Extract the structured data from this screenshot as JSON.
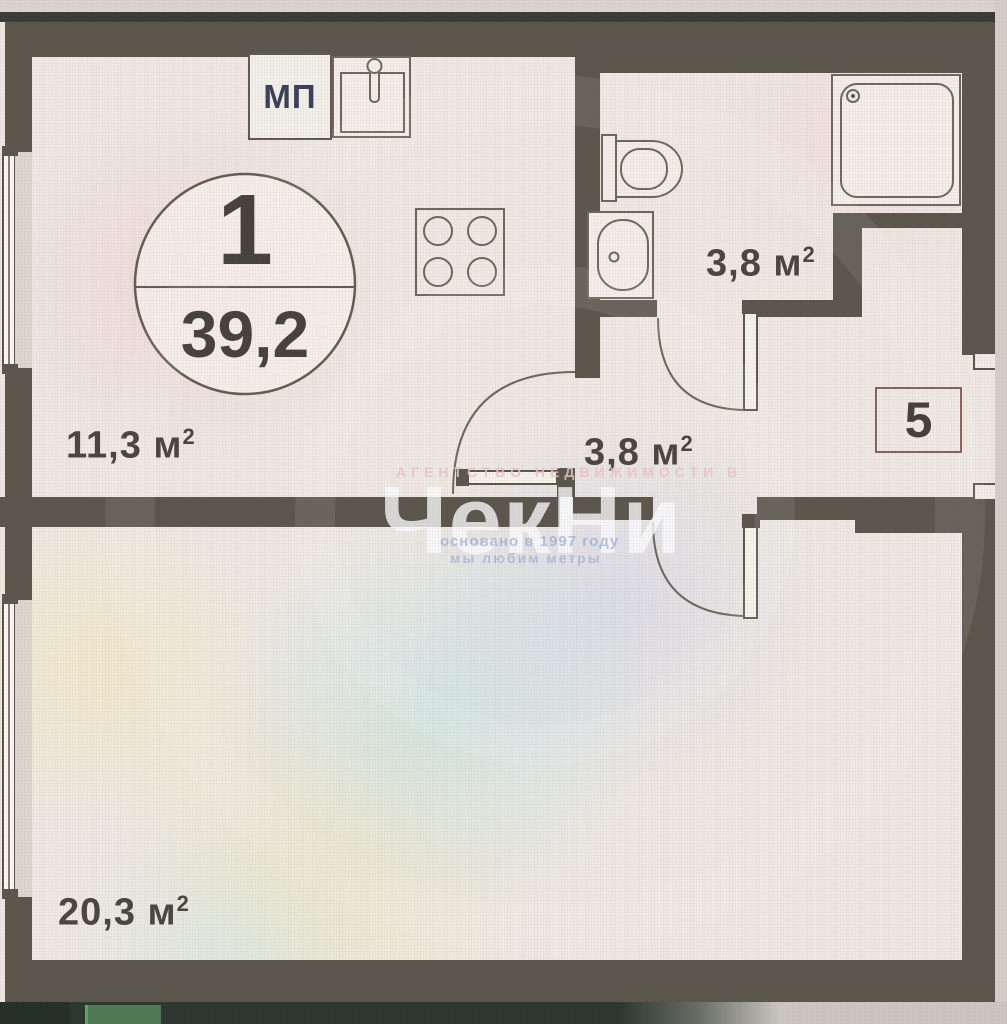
{
  "plan": {
    "apartment_circle": {
      "number": "1",
      "area": "39,2"
    },
    "window_label": "МП",
    "unit_number": "5",
    "rooms": {
      "kitchen": {
        "area": "11,3 м",
        "sup": "2"
      },
      "bathroom": {
        "area": "3,8 м",
        "sup": "2"
      },
      "hall": {
        "area": "3,8 м",
        "sup": "2"
      },
      "living": {
        "area": "20,3 м",
        "sup": "2"
      }
    },
    "icons": [
      "stove-icon",
      "kitchen-sink-icon",
      "toilet-icon",
      "washbasin-icon",
      "shower-tray-icon",
      "window-icon",
      "door-arc-icon"
    ],
    "watermark": {
      "agency_line": "АГЕНТСТВО НЕДВИЖИМОСТИ В",
      "brand": "ЧекНи",
      "founded_line": "основано в 1997 году",
      "slogan_line": "мы любим метры"
    },
    "colors": {
      "wall": "#5b564b",
      "floor": "#f0eae3",
      "fixture_line": "#6f675b",
      "unit_box_border": "#86655a",
      "label_text": "#4b463d",
      "mp_text": "#3c3f58"
    }
  }
}
